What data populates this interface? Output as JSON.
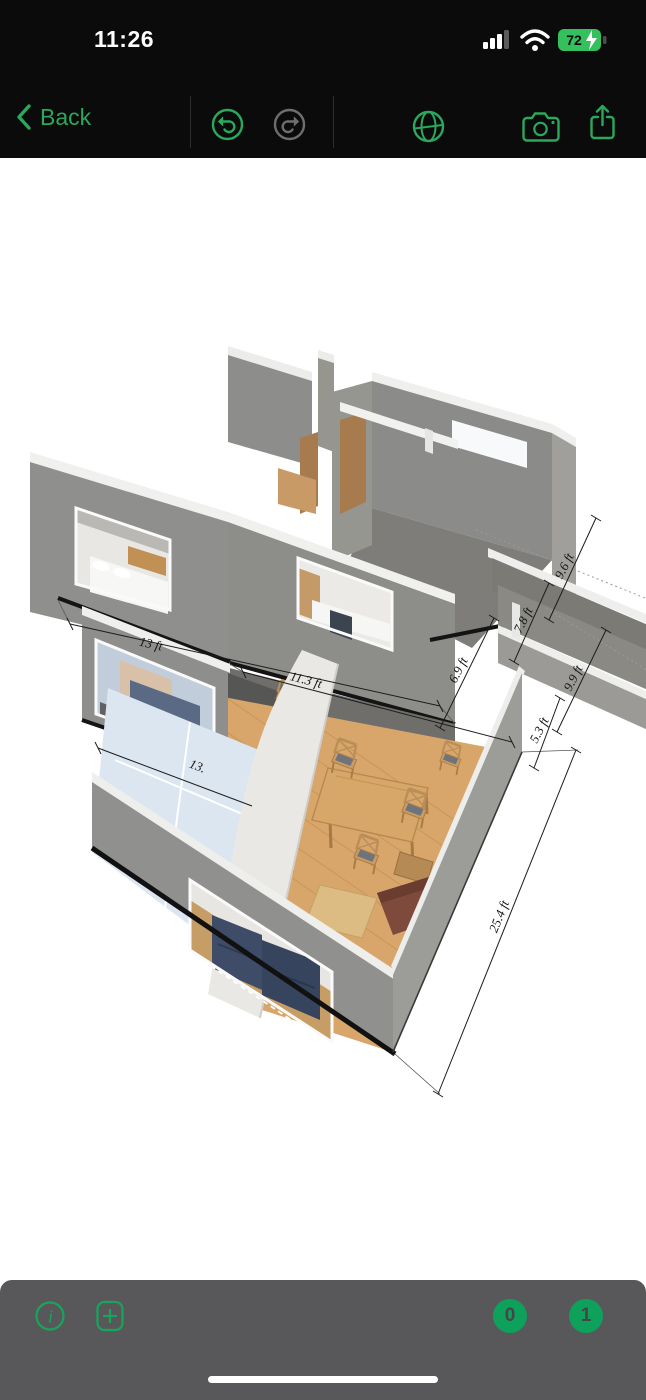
{
  "status_bar": {
    "time": "11:26",
    "battery_percent": "72",
    "icons": [
      "cellular-signal-icon",
      "wifi-icon",
      "battery-charging-icon"
    ]
  },
  "toolbar": {
    "back_label": "Back",
    "icons": [
      "back-chevron-icon",
      "undo-icon",
      "redo-icon",
      "orbit-view-icon",
      "camera-icon",
      "share-icon"
    ]
  },
  "scene": {
    "view": "3d-floorplan-two-story-dollhouse",
    "dimension_labels": [
      {
        "text": "13 ft"
      },
      {
        "text": "13."
      },
      {
        "text": "11.3 ft"
      },
      {
        "text": "6.9 ft"
      },
      {
        "text": "7.8 ft"
      },
      {
        "text": "9.6 ft"
      },
      {
        "text": "9.9 ft"
      },
      {
        "text": "5.3 ft"
      },
      {
        "text": "25.4 ft"
      }
    ]
  },
  "bottom_bar": {
    "icons": [
      "info-icon",
      "add-item-icon"
    ],
    "floor_buttons": [
      {
        "label": "0"
      },
      {
        "label": "1"
      }
    ]
  },
  "colors": {
    "accent_green": "#2aa85c",
    "badge_green": "#0da15c",
    "header_bg": "#0b0b0b",
    "bottom_bar_bg": "#58585a",
    "canvas_bg": "#ffffff",
    "battery_green": "#35c05e",
    "wall_gray": "#8e8e8c",
    "floor_wood": "#d8a66a"
  }
}
